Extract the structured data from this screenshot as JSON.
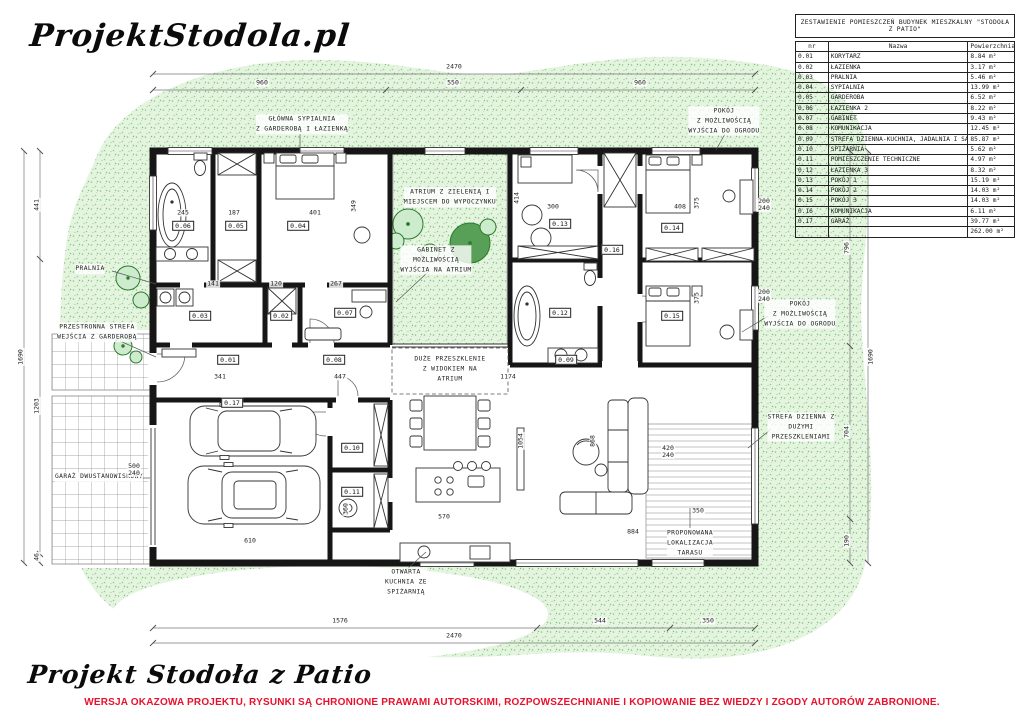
{
  "brand": {
    "logo": "ProjektStodola.pl"
  },
  "footer": {
    "title": "Projekt Stodoła z Patio",
    "disclaimer": "WERSJA OKAZOWA PROJEKTU, RYSUNKI  SĄ CHRONIONE PRAWAMI AUTORSKIMI, ROZPOWSZECHNIANIE I KOPIOWANIE BEZ WIEDZY I ZGODY AUTORÓW ZABRONIONE.",
    "disclaimer_color": "#e8112d"
  },
  "colors": {
    "grass_base": "#e4f4df",
    "grass_dot": "#85c785",
    "tree_green": "#2e7a2e",
    "wall_black": "#161616",
    "accent_red": "#e8112d"
  },
  "table": {
    "title": "ZESTAWIENIE POMIESZCZEŃ BUDYNEK MIESZKALNY \"STODOŁA Z PATIO\"",
    "columns": [
      "nr",
      "Nazwa",
      "Powierzchnia"
    ],
    "rows": [
      [
        "0.01",
        "KORYTARZ",
        "8.84 m²"
      ],
      [
        "0.02",
        "ŁAZIENKA",
        "3.17 m²"
      ],
      [
        "0.03",
        "PRALNIA",
        "5.46 m²"
      ],
      [
        "0.04",
        "SYPIALNIA",
        "13.99 m²"
      ],
      [
        "0.05",
        "GARDEROBA",
        "6.52 m²"
      ],
      [
        "0.06",
        "ŁAZIENKA 2",
        "8.22 m²"
      ],
      [
        "0.07",
        "GABINET",
        "9.43 m²"
      ],
      [
        "0.08",
        "KOMUNIKACJA",
        "12.45 m²"
      ],
      [
        "0.09",
        "STREFA DZIENNA-KUCHNIA, JADALNIA I SALON",
        "85.87 m²"
      ],
      [
        "0.10",
        "SPIŻARNIA",
        "5.62 m²"
      ],
      [
        "0.11",
        "POMIESZCZENIE TECHNICZNE",
        "4.97 m²"
      ],
      [
        "0.12",
        "ŁAZIENKA 3",
        "8.32 m²"
      ],
      [
        "0.13",
        "POKÓJ 1",
        "15.19 m²"
      ],
      [
        "0.14",
        "POKÓJ 2",
        "14.03 m²"
      ],
      [
        "0.15",
        "POKÓJ 3",
        "14.03 m²"
      ],
      [
        "0.16",
        "KOMUNIKACJA",
        "6.11 m²"
      ],
      [
        "0.17",
        "GARAŻ",
        "39.77 m²"
      ]
    ],
    "total": "262.00 m²"
  },
  "plan": {
    "rooms": [
      "0.01",
      "0.02",
      "0.03",
      "0.04",
      "0.05",
      "0.06",
      "0.07",
      "0.08",
      "0.09",
      "0.10",
      "0.11",
      "0.12",
      "0.13",
      "0.14",
      "0.15",
      "0.16",
      "0.17"
    ],
    "annotations": {
      "main_bedroom": "GŁÓWNA SYPIALNIA\nZ GARDEROBĄ I ŁAZIENKĄ",
      "room_garden_top": "POKÓJ\nZ MOŻLIWOŚCIĄ\nWYJŚCIA DO OGRODU",
      "atrium": "ATRIUM Z ZIELENIĄ I\nMIEJSCEM DO WYPOCZYNKU",
      "gabinet": "GABINET Z\nMOŻLIWOŚCIĄ\nWYJŚCIA NA ATRIUM",
      "pralnia": "PRALNIA",
      "entry": "PRZESTRONNA STREFA\nWEJŚCIA Z GARDEROBĄ",
      "garage": "GARAŻ DWUSTANOWISKOWY",
      "room_garden_right": "POKÓJ\nZ MOŻLIWOŚCIĄ\nWYJŚCIA DO OGRODU",
      "living_glazing": "STREFA DZIENNA Z\nDUŻYMI\nPRZESZKLENIAMI",
      "big_glazing": "DUŻE PRZESZKLENIE\nZ WIDOKIEM NA\nATRIUM",
      "terrace": "PROPONOWANA\nLOKALIZACJA\nTARASU",
      "kitchen": "OTWARTA\nKUCHNIA ZE\nSPIŻARNIĄ"
    },
    "dims": {
      "top_total": "2470",
      "top_left": "960",
      "top_mid": "550",
      "top_right": "960",
      "bottom_left": "1576",
      "bottom_mid": "544",
      "bottom_right": "350",
      "bottom_total": "2470",
      "left_top": "441",
      "left_total": "1690",
      "left_mid": "1203",
      "left_bottom": "46",
      "right_top": "796",
      "right_total": "1690",
      "right_mid": "704",
      "right_bottom": "190",
      "inner": [
        "245",
        "187",
        "401",
        "349",
        "141",
        "120",
        "267",
        "341",
        "447",
        "300",
        "408",
        "414",
        "375",
        "375",
        "1174",
        "1054",
        "868",
        "570",
        "610",
        "884",
        "350",
        "360",
        "200\n240",
        "200\n240",
        "500\n240",
        "420\n240"
      ]
    }
  }
}
